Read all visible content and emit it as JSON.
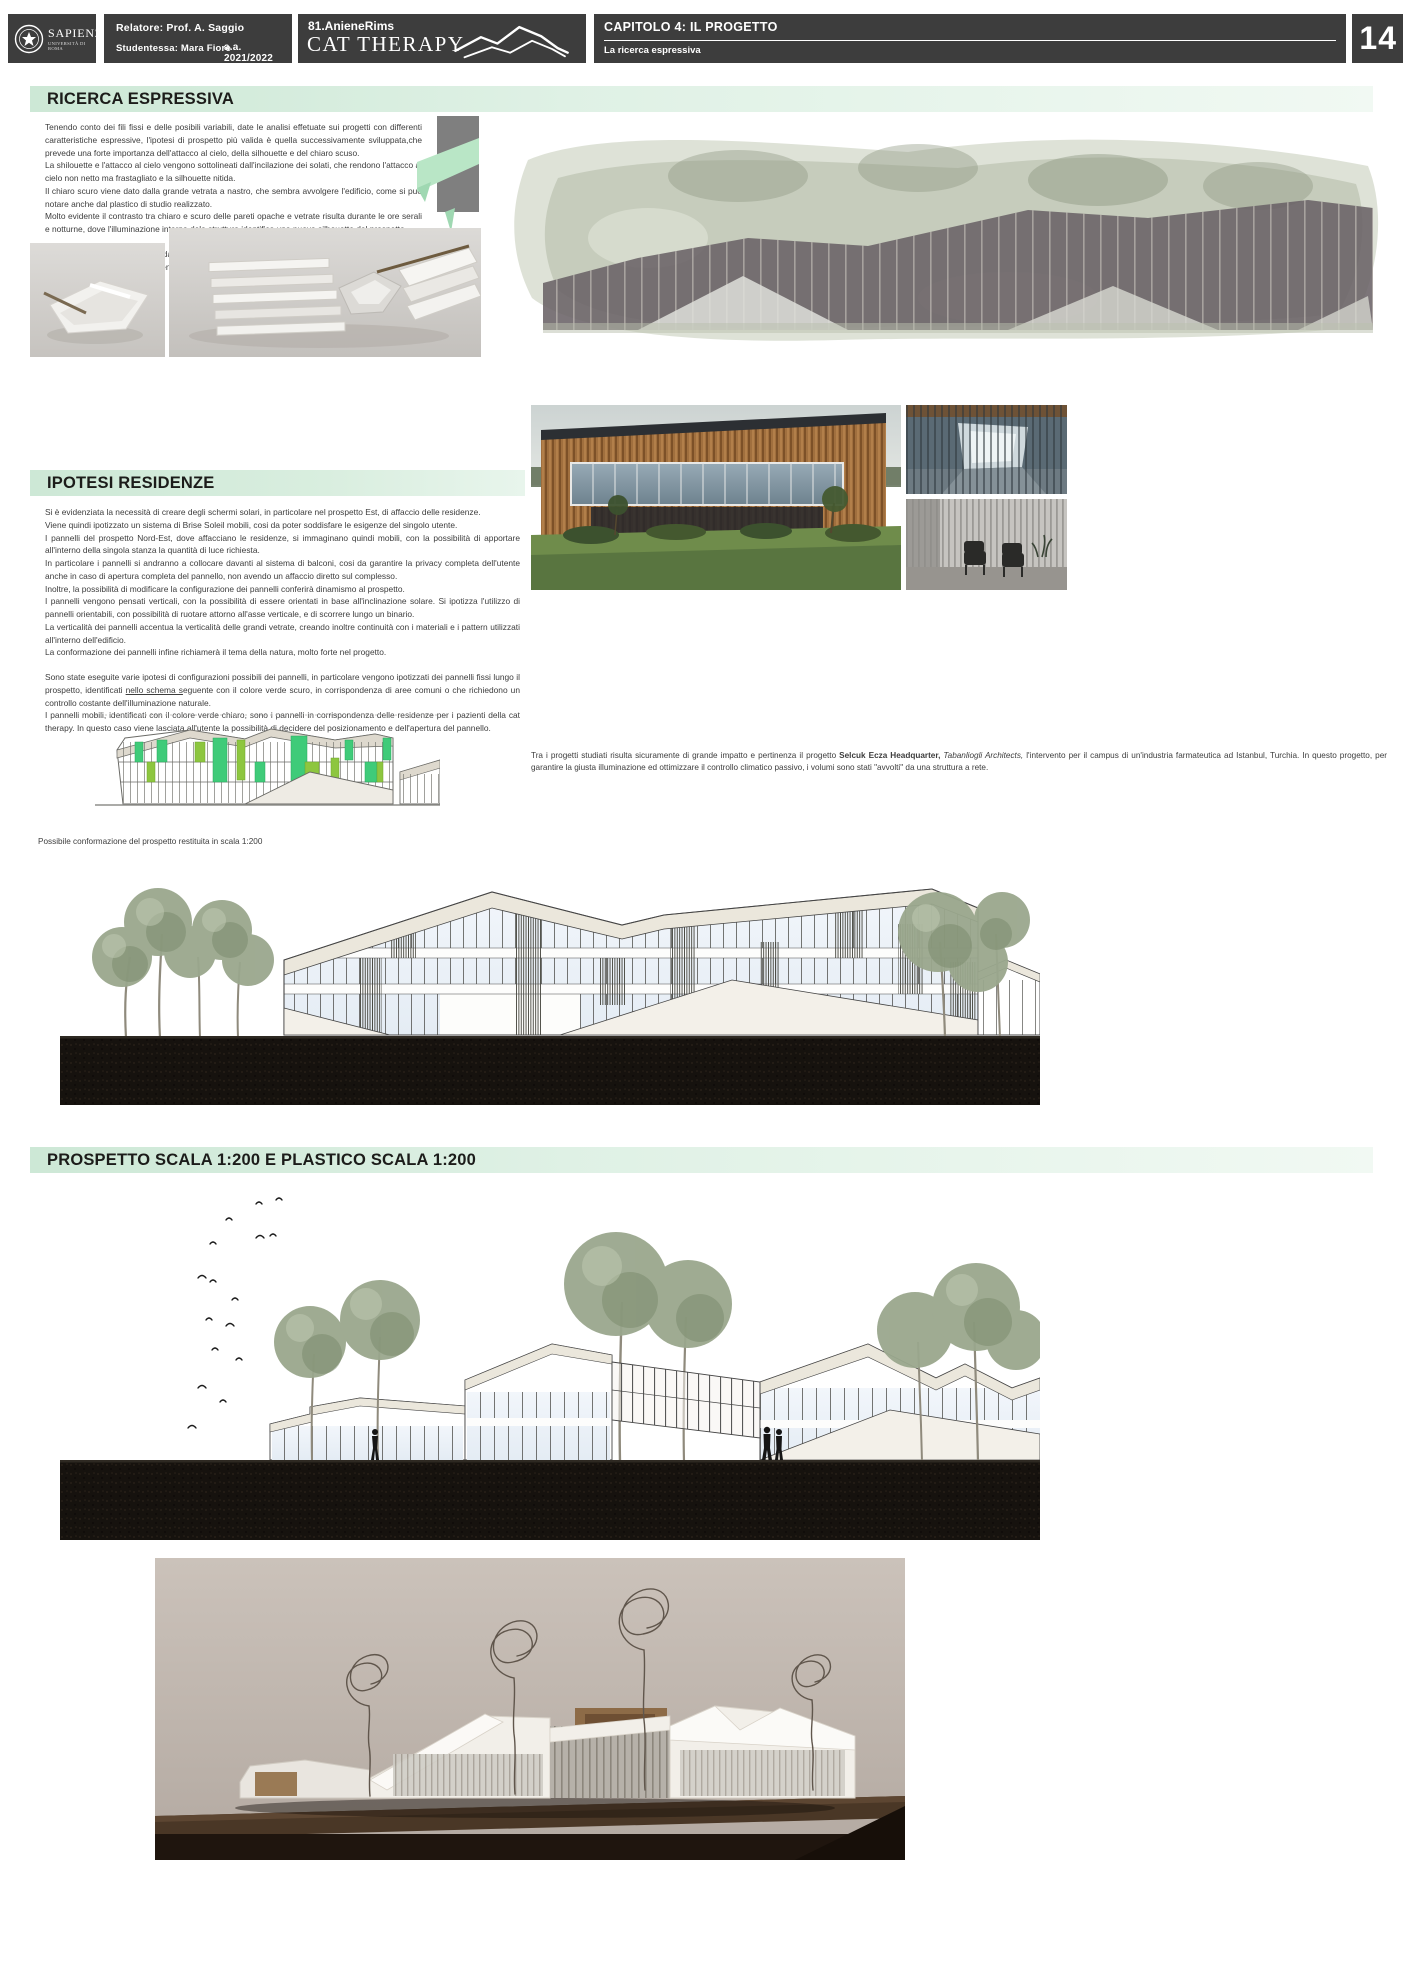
{
  "header": {
    "university": "SAPIENZA",
    "university_sub": "UNIVERSITÀ DI ROMA",
    "relatore": "Relatore: Prof. A. Saggio",
    "studentessa": "Studentessa: Mara Fiore",
    "anno": "a.a. 2021/2022",
    "project_code": "81.AnieneRims",
    "project_name": "CAT THERAPY",
    "chapter": "CAPITOLO 4: IL PROGETTO",
    "chapter_sub": "La ricerca espressiva",
    "page": "14"
  },
  "sections": {
    "ricerca": {
      "title": "RICERCA ESPRESSIVA",
      "paragraphs": [
        "Tenendo conto dei fili fissi e delle posibili variabili, date le analisi effetuate sui progetti con differenti caratteristiche espressive, l'ipotesi di prospetto più valida è quella successivamente sviluppata,che prevede una forte importanza dell'attacco al cielo, della silhouette e del chiaro scuso.",
        "La shilouette e l'attacco al cielo vengono sottolineati dall'incilazione dei solati, che rendono l'attacco al cielo non netto ma frastagliato e la silhouette nitida.",
        "Il chiaro scuro viene  dato dalla grande vetrata a nastro, che sembra avvolgere l'edificio, come si può notare anche dal plastico di studio realizzato.",
        "Molto evidente il contrasto tra chiaro e scuro delle pareti opache e vetrate risulta durante le ore serali e notturne, dove l'illuminazione interna dela struttura identifica una nuova silhouette del prospetto.",
        "Il concecpt del prospetto nasce dall'idea del nastro, come si può notare dalle foto della scacchiera.",
        "La vetrata avvolgerà l'edificio, entrando in sintonia con esso fino ad essere inglobata, dando vita a questa vetrata continua."
      ]
    },
    "ipotesi": {
      "title": "IPOTESI RESIDENZE",
      "paragraphs": [
        "Si è evidenziata la necessità di creare degli schermi solari, in particolare nel prospetto Est, di affaccio delle residenze.",
        "Viene quindi ipotizzato un sistema di Brise Soleil mobili, cosi da poter soddisfare le esigenze del singolo utente.",
        "I pannelli del prospetto Nord-Est, dove affacciano le residenze, si immaginano quindi mobili, con la possibilità di apportare all'interno della singola stanza la quantità di luce richiesta.",
        "In particolare i pannelli si andranno a collocare davanti al sistema di balconi, cosi da garantire la privacy completa dell'utente anche in caso di apertura completa del pannello, non avendo un affaccio diretto sul complesso.",
        "Inoltre, la possibilità di modificare la configurazione dei pannelli conferirà dinamismo al prospetto.",
        "I pannelli vengono pensati verticali, con la possibilità di essere orientati in base all'inclinazione solare. Si ipotizza l'utilizzo di pannelli orientabili, con possibilità di ruotare attorno all'asse verticale, e di scorrere lungo un binario.",
        "La verticalità dei pannelli accentua la verticalità delle grandi vetrate, creando inoltre continuità con i materiali e i pattern utilizzati all'interno dell'edificio.",
        "La conformazione dei pannelli infine richiamerà il tema della natura, molto forte nel progetto."
      ],
      "p9_pre": "Sono state eseguite varie ipotesi di configurazioni possibili dei pannelli, in particolare vengono ipotizzati dei pannelli fissi lungo il prospetto, identificati ",
      "p9_underlined": "nello schema s",
      "p9_post": "eguente con il colore verde scuro, in corrispondenza di aree comuni o che richiedono un controllo costante dell'illuminazione naturale.",
      "p10": "I pannelli mobili, identificati con il colore verde chiaro, sono i pannelli in corrispondenza delle residenze per i pazienti della cat therapy. In questo caso viene lasciata all'utente la possibilità di decidere del posizionamento e dell'apertura del pannello."
    },
    "prospetto": {
      "title": "PROSPETTO SCALA 1:200 E PLASTICO SCALA 1:200"
    }
  },
  "captions": {
    "reference_pre": "Tra i progetti  studiati risulta sicuramente di grande impatto e pertinenza il progetto ",
    "reference_bold": "Selcuk Ecza Headquarter,",
    "reference_italic": " Tabanliogli Architects,",
    "reference_post": " l'intervento per il campus di un'industria farmateutica ad Istanbul, Turchia. In questo progetto, per garantire la giusta illuminazione ed ottimizzare il controllo climatico passivo, i volumi sono stati \"avvolti\" da una struttura a rete.",
    "scale_note": "Possibile conformazione del prospetto restituita in scala 1:200"
  },
  "colors": {
    "header_bar": "#3d3d3d",
    "section_band_green": "#cde8d6",
    "fixed_panel_green": "#3fcb79",
    "mobile_panel_green": "#8dc63f",
    "ribbon_green": "#b9e6c6"
  }
}
